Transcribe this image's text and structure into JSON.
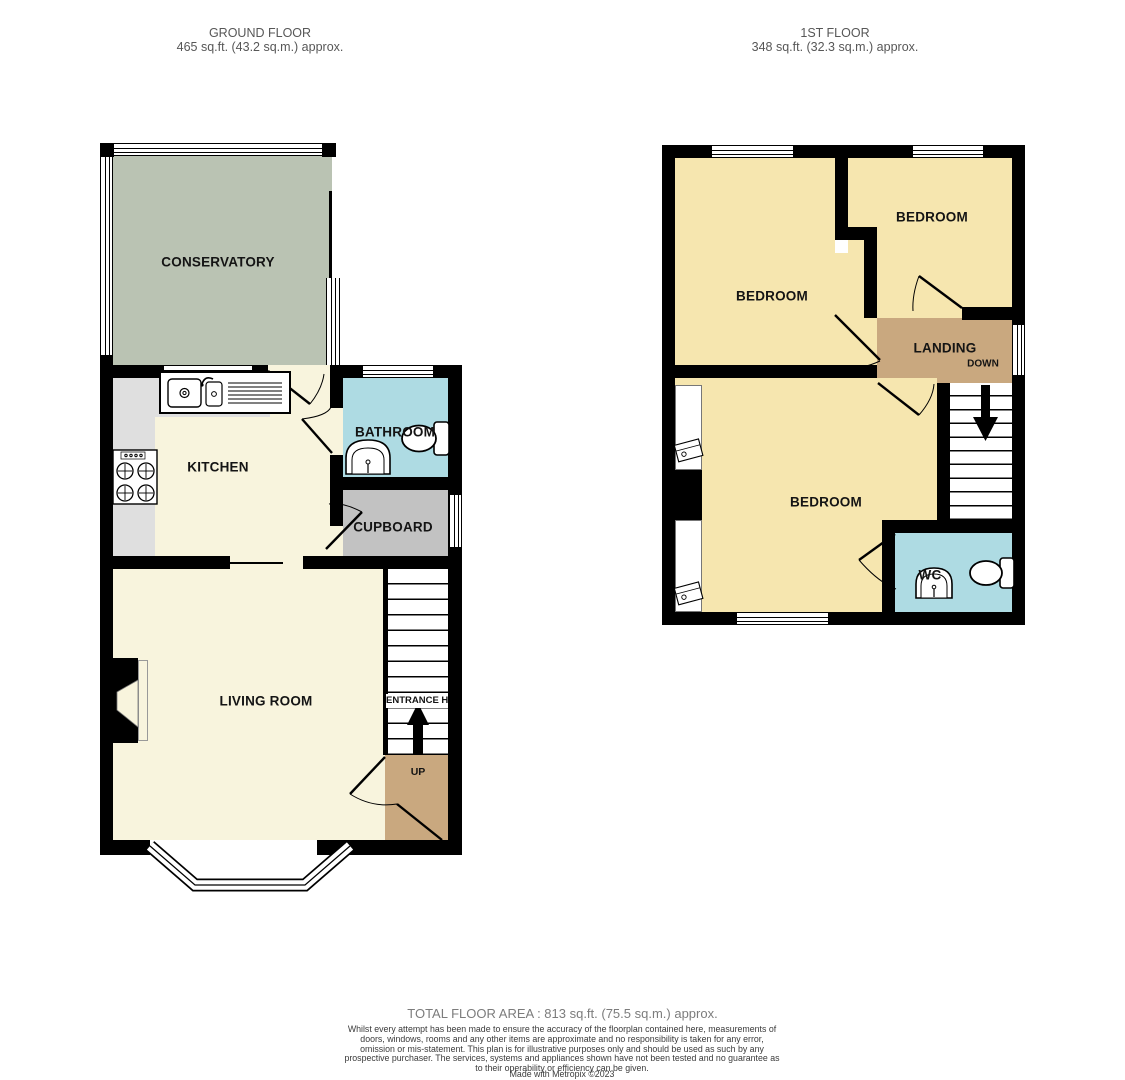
{
  "headers": {
    "ground": {
      "title": "GROUND FLOOR",
      "area": "465 sq.ft. (43.2 sq.m.) approx."
    },
    "first": {
      "title": "1ST FLOOR",
      "area": "348 sq.ft. (32.3 sq.m.) approx."
    }
  },
  "ground_floor": {
    "labels": {
      "conservatory": "CONSERVATORY",
      "kitchen": "KITCHEN",
      "bathroom": "BATHROOM",
      "cupboard": "CUPBOARD",
      "living_room": "LIVING ROOM",
      "entrance_hall": "ENTRANCE HALL",
      "up": "UP"
    }
  },
  "first_floor": {
    "labels": {
      "bedroom_top_left": "BEDROOM",
      "bedroom_top_right": "BEDROOM",
      "bedroom_bottom": "BEDROOM",
      "landing": "LANDING",
      "down": "DOWN",
      "wc": "WC"
    }
  },
  "footer": {
    "total": "TOTAL FLOOR AREA : 813 sq.ft. (75.5 sq.m.) approx.",
    "disclaimer": "Whilst every attempt has been made to ensure the accuracy of the floorplan contained here, measurements of doors, windows, rooms and any other items are approximate and no responsibility is taken for any error, omission or mis-statement. This plan is for illustrative purposes only and should be used as such by any prospective purchaser. The services, systems and appliances shown have not been tested and no guarantee as to their operability or efficiency can be given.",
    "credit": "Made with Metropix ©2023"
  },
  "colors": {
    "wall": "#000000",
    "conservatory": "#bac3b3",
    "floor_cream": "#f8f4dd",
    "bedroom_yellow": "#f6e6af",
    "bath_blue": "#aedbe3",
    "cupboard_gray": "#c2c2c2",
    "counter_gray": "#dfdfdf",
    "stairs_tan": "#c9a87f"
  }
}
